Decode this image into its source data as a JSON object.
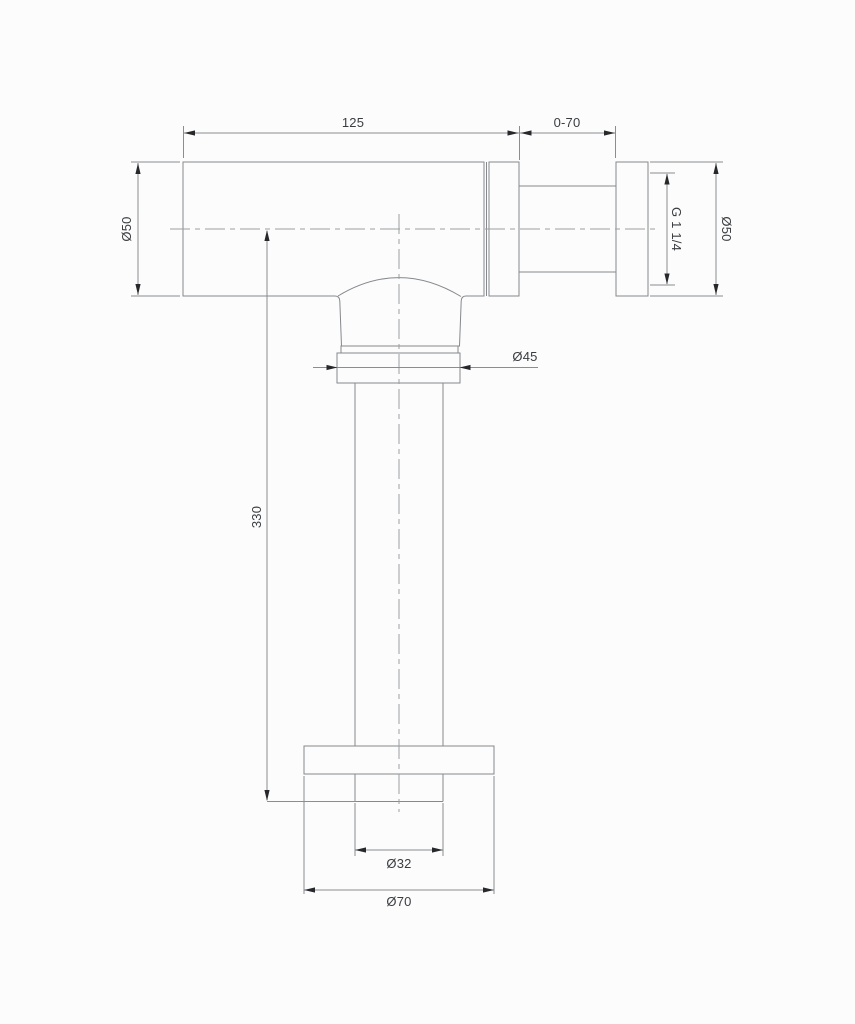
{
  "drawing": {
    "background_color": "#fcfcfc",
    "outline_color": "#85888c",
    "dimension_line_color": "#8a8d91",
    "centerline_color": "#9b9ea2",
    "arrow_color": "#26282b",
    "text_color": "#3a3d40",
    "labels": {
      "top_width": "125",
      "adjustment_range": "0-70",
      "body_diameter": "Ø50",
      "thread_size": "G 1 1/4",
      "connector_diameter": "Ø50",
      "nut_diameter": "Ø45",
      "tube_length": "330",
      "tube_diameter": "Ø32",
      "base_flange_diameter": "Ø70"
    }
  }
}
